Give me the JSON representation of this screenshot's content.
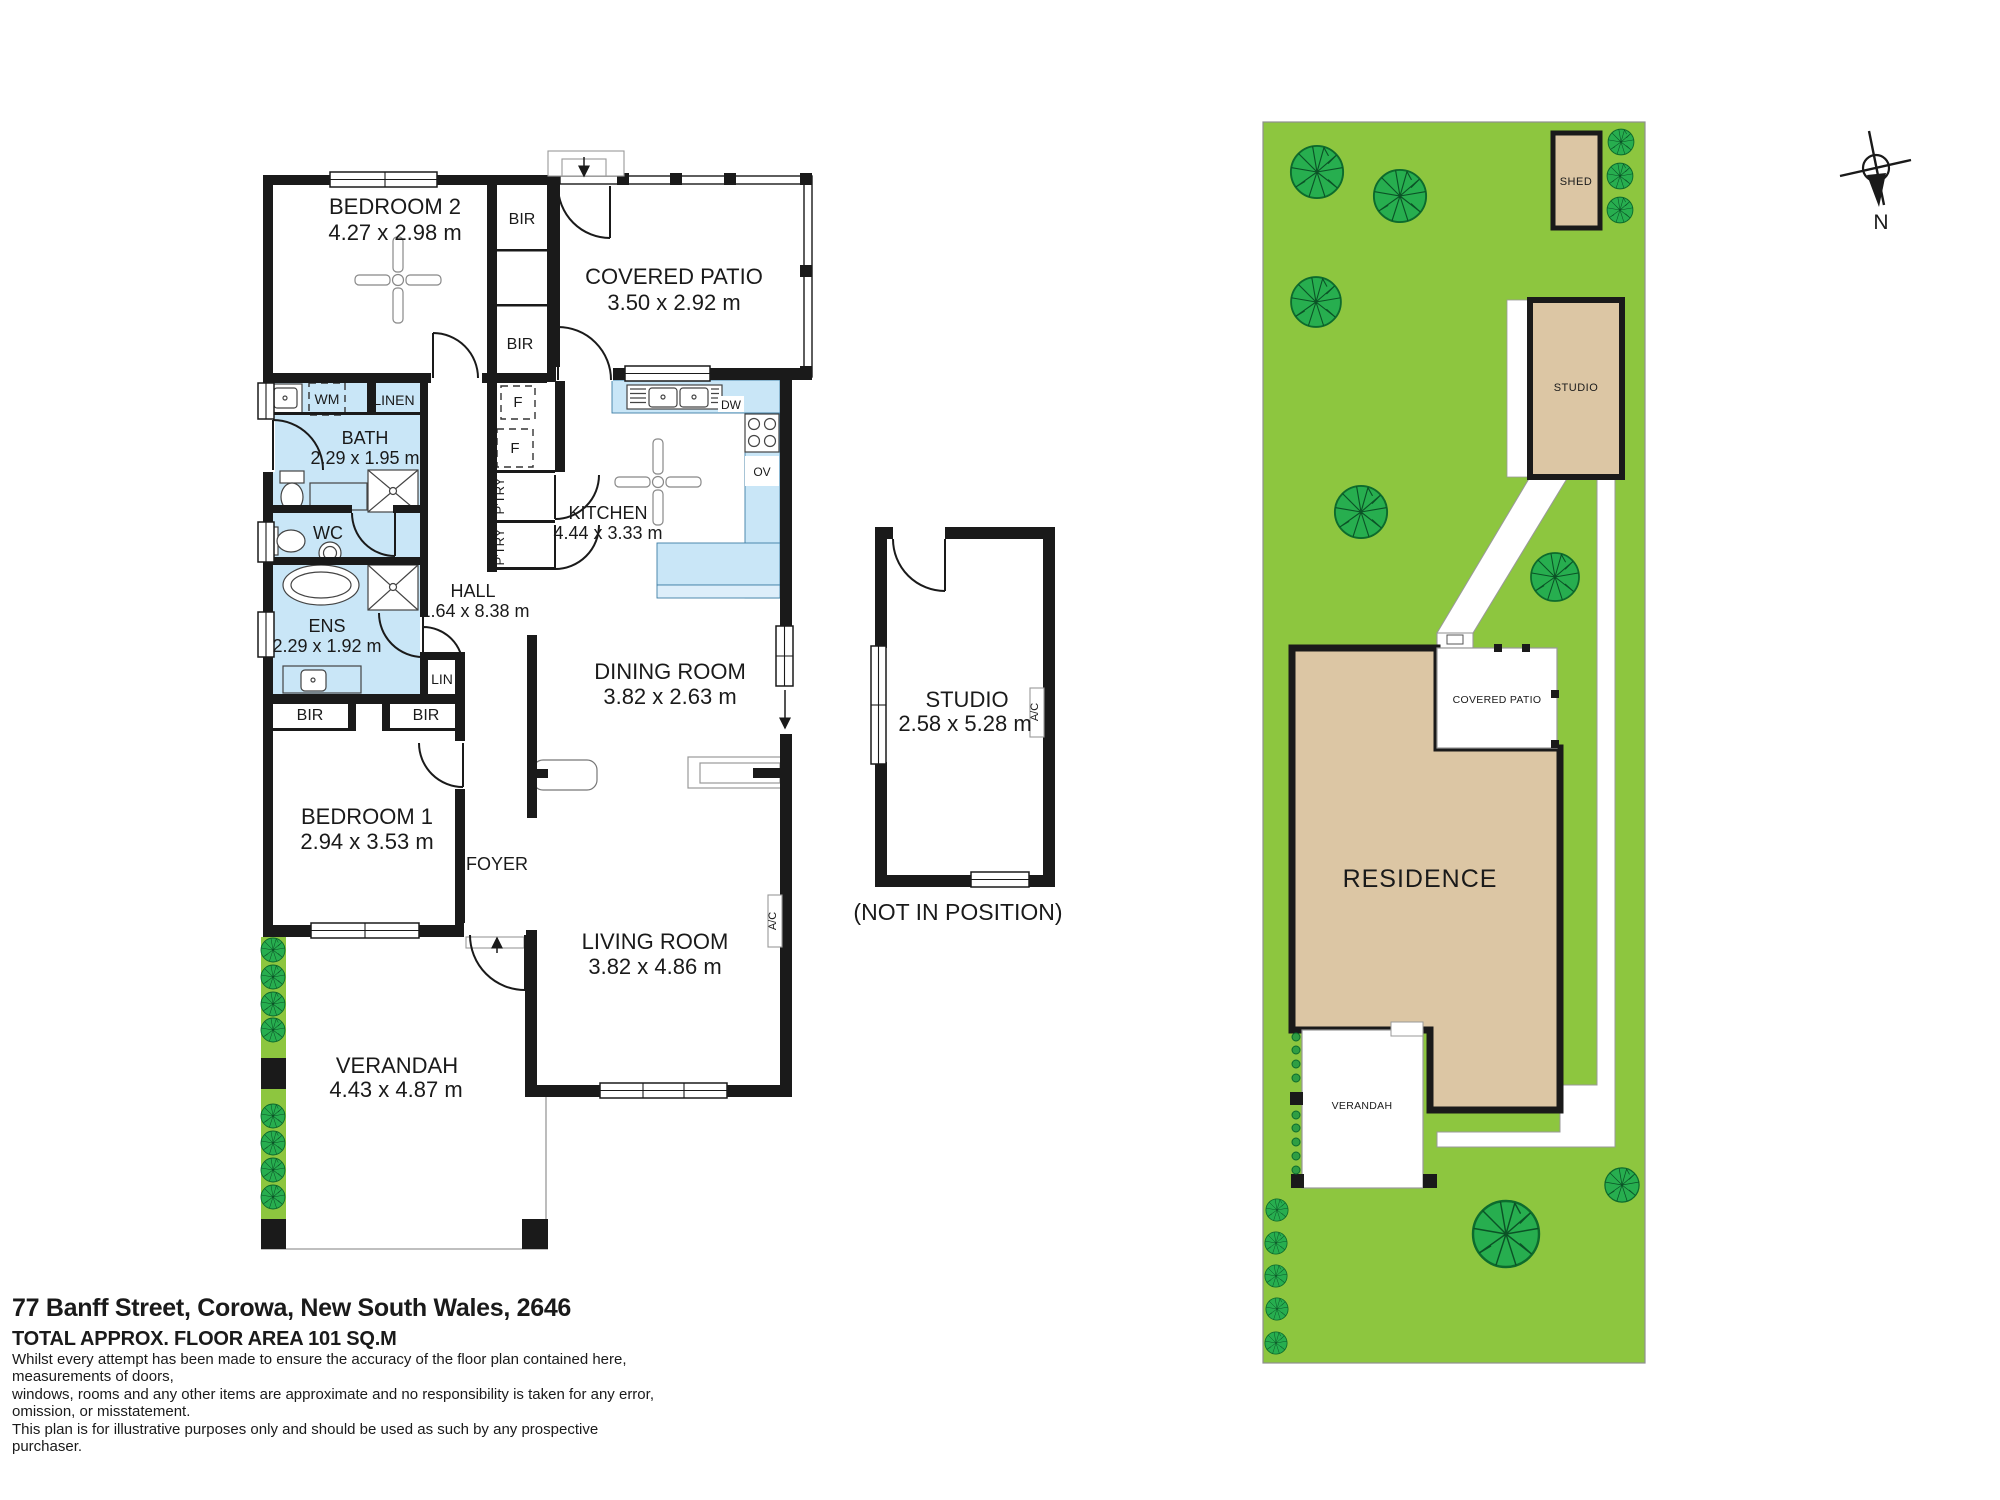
{
  "colors": {
    "wall": "#1a1a1a",
    "wet_area": "#c9e6f7",
    "lawn": "#8dc63f",
    "tree": "#27ae4f",
    "structure_tan": "#dcc6a4"
  },
  "labels": {
    "bedroom2": {
      "name": "BEDROOM 2",
      "dims": "4.27 x 2.98 m"
    },
    "covered_patio": {
      "name": "COVERED PATIO",
      "dims": "3.50 x 2.92 m"
    },
    "bath": {
      "name": "BATH",
      "dims": "2.29 x 1.95 m"
    },
    "wc": {
      "name": "WC"
    },
    "kitchen": {
      "name": "KITCHEN",
      "dims": "4.44 x 3.33 m"
    },
    "hall": {
      "name": "HALL",
      "dims": "1.64 x 8.38 m"
    },
    "ens": {
      "name": "ENS",
      "dims": "2.29 x 1.92 m"
    },
    "dining": {
      "name": "DINING ROOM",
      "dims": "3.82 x 2.63 m"
    },
    "bedroom1": {
      "name": "BEDROOM 1",
      "dims": "2.94 x 3.53 m"
    },
    "foyer": {
      "name": "FOYER"
    },
    "living": {
      "name": "LIVING ROOM",
      "dims": "3.82 x 4.86 m"
    },
    "verandah": {
      "name": "VERANDAH",
      "dims": "4.43 x 4.87 m"
    },
    "studio": {
      "name": "STUDIO",
      "dims": "2.58 x 5.28 m",
      "note": "(NOT IN POSITION)"
    }
  },
  "fixtures": {
    "bir": "BIR",
    "linen": "LINEN",
    "lin": "LIN",
    "wm": "WM",
    "fridge": "F",
    "pantry": "P'TRY",
    "dw": "DW",
    "ov": "OV",
    "ac": "A/C"
  },
  "site": {
    "shed": "SHED",
    "studio": "STUDIO",
    "covered_patio": "COVERED PATIO",
    "residence": "RESIDENCE",
    "verandah": "VERANDAH"
  },
  "compass": {
    "north": "N"
  },
  "footer": {
    "address": "77 Banff Street, Corowa, New South Wales, 2646",
    "area": "TOTAL APPROX. FLOOR AREA 101 SQ.M",
    "disclaimer1": "Whilst every attempt has been made to ensure the accuracy of the floor plan contained here, measurements of doors,",
    "disclaimer2": "windows, rooms and any other items are approximate and no responsibility is taken for any error, omission, or misstatement.",
    "disclaimer3": "This plan is for illustrative purposes only and should be used as such by any prospective purchaser."
  }
}
